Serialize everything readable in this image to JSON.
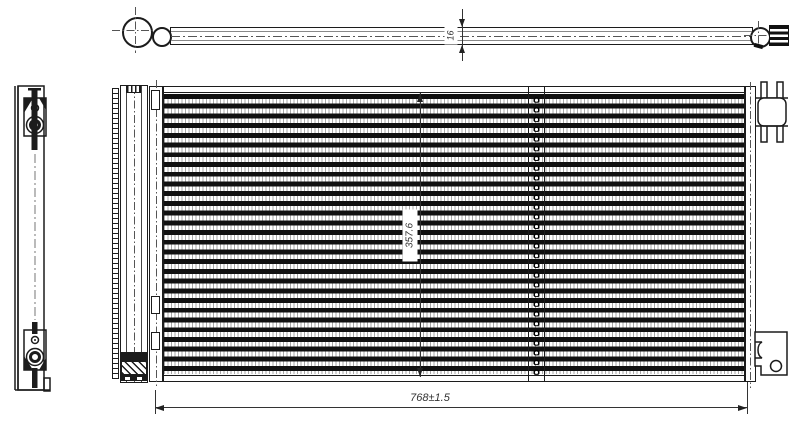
{
  "dimensions": {
    "pipe_diameter": "16",
    "core_height": "357.6",
    "overall_width": "768±1.5"
  },
  "colors": {
    "line": "#1c1c1c",
    "fin_gray": "#a8a8a8",
    "background": "#ffffff"
  }
}
